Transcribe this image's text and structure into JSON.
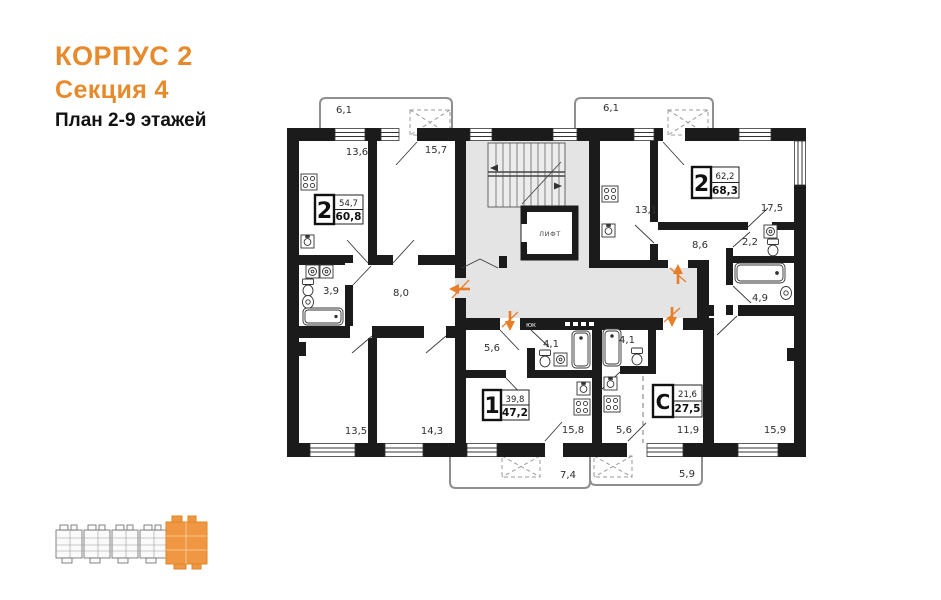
{
  "colors": {
    "accent": "#e78a2b",
    "wall": "#1b1b1b",
    "common_area": "#e4e4e4",
    "arrow": "#e87f28"
  },
  "header": {
    "building": "КОРПУС 2",
    "section": "Секция 4",
    "plan_title": "План 2-9 этажей"
  },
  "plan": {
    "elevator_label": "ЛИФТ",
    "duct_label": "ЮК",
    "apartments": [
      {
        "rooms": "2",
        "area_top": "54,7",
        "area_bottom": "60,8"
      },
      {
        "rooms": "2",
        "area_top": "62,2",
        "area_bottom": "68,3"
      },
      {
        "rooms": "1",
        "area_top": "39,8",
        "area_bottom": "47,2"
      },
      {
        "rooms": "С",
        "area_top": "21,6",
        "area_bottom": "27,5"
      }
    ],
    "areas": {
      "balcony_top_left": "6,1",
      "kitchen_left": "13,6",
      "room_top_left": "15,7",
      "balcony_top_right": "6,1",
      "kitchen_right": "13,1",
      "room_top_right": "17,5",
      "hall_right": "8,6",
      "wc_right": "2,2",
      "bath_right": "4,9",
      "bath_left": "3,9",
      "hall_left": "8,0",
      "room_bottom_left": "13,5",
      "room_bottom_mid": "14,3",
      "hall_apt1": "5,6",
      "bath_apt1": "4,1",
      "bath_studio": "4,1",
      "kitchen_apt1": "15,8",
      "kitchen_studio": "5,6",
      "room_studio": "11,9",
      "room_bottom_right": "15,9",
      "balcony_bottom_left": "7,4",
      "balcony_bottom_right": "5,9"
    }
  }
}
